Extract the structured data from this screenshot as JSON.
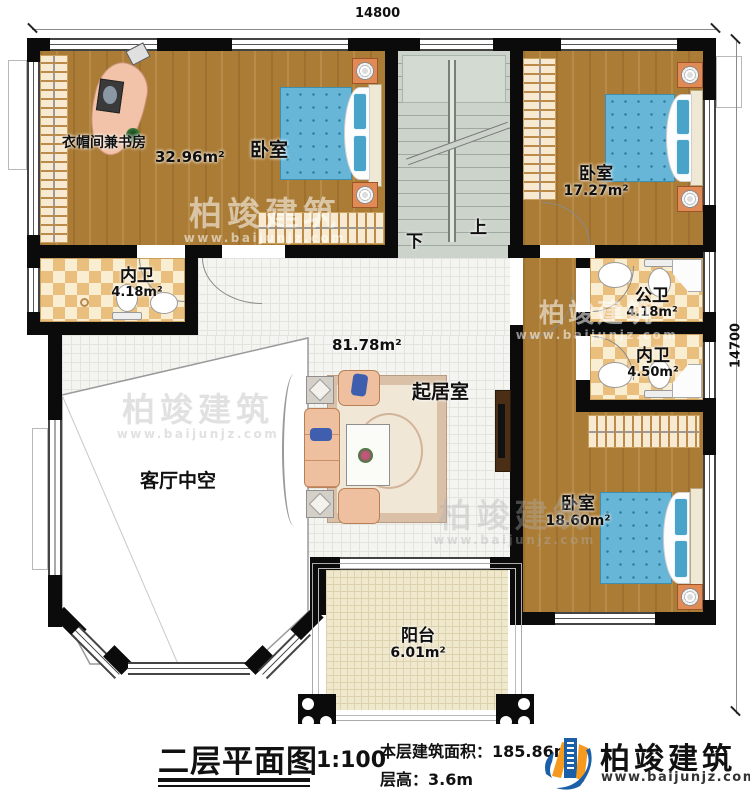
{
  "dimensions": {
    "width_top": "14800",
    "height_right": "14700"
  },
  "rooms": {
    "study": {
      "label": "衣帽间兼书房",
      "area": "32.96m²"
    },
    "bedroom_top": {
      "label": "卧室"
    },
    "bedroom_right": {
      "label": "卧室",
      "area": "17.27m²"
    },
    "bath_left": {
      "label": "内卫",
      "area": "4.18m²"
    },
    "bath_public": {
      "label": "公卫",
      "area": "4.18m²"
    },
    "bath_right": {
      "label": "内卫",
      "area": "4.50m²"
    },
    "living": {
      "label": "起居室",
      "area": "81.78m²"
    },
    "void": {
      "label": "客厅中空"
    },
    "bedroom_bottom": {
      "label": "卧室",
      "area": "18.60m²"
    },
    "balcony": {
      "label": "阳台",
      "area": "6.01m²"
    }
  },
  "stairs": {
    "up": "上",
    "down": "下"
  },
  "watermark": {
    "brand": "柏竣建筑",
    "url": "www.baijunjz.com"
  },
  "title_block": {
    "title": "二层平面图",
    "scale": "1:100",
    "floor_area_label": "本层建筑面积：",
    "floor_area_value": "185.86m²",
    "floor_height_label": "层高：",
    "floor_height_value": "3.6m",
    "brand": "柏竣建筑",
    "brand_url": "www.baijunjz.com"
  },
  "colors": {
    "wall": "#0b0b0b",
    "wood": "#ab7c36",
    "tile": "#f4f4f1",
    "bed_blue": "#67b6d7",
    "logo_blue": "#1b5fa8",
    "logo_orange": "#f59a1e"
  }
}
